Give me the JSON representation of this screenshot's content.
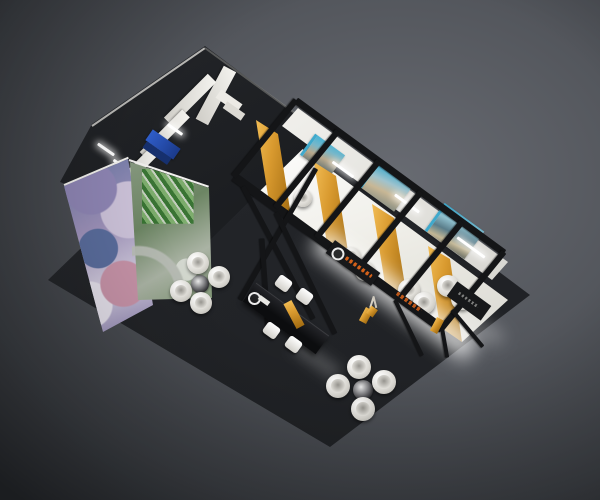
{
  "meta": {
    "title": "3D render of an exhibition stand, aerial isometric view",
    "canvas_width": 600,
    "canvas_height": 500
  },
  "palette": {
    "backdrop_light": "#686b72",
    "backdrop_mid": "#53565c",
    "backdrop_dark": "#3b3e43",
    "platform": "#232528",
    "frame_black": "#141517",
    "wall_dark": "#1d1f22",
    "wall_white": "#edece8",
    "floor_white": "#f6f5f1",
    "gold": "#d99a2f",
    "gold_dark": "#a06a10",
    "poster_teal": "#3fa9cc",
    "chair_white": "#f2f1ec",
    "cabinet_blue": "#2b57c0",
    "accent_orange": "#d2601a"
  },
  "scene": {
    "background": {
      "label": "studio gradient backdrop, brightest upper right"
    },
    "platform": {
      "label": "raised dark charcoal floor platform, diamond orientation"
    },
    "meeting_rooms": {
      "label": "enclosed back rooms with tall charcoal walls",
      "white_partitions": 4,
      "features": [
        "blue cabinet",
        "white counter blocks",
        "wall-mounted screen",
        "ceiling light bars"
      ],
      "graphic_walls": [
        {
          "label": "purple collage graphic wall (front-left face)"
        },
        {
          "label": "aerial green campus photo graphic wall (front-right face)"
        }
      ]
    },
    "booth_row": {
      "label": "row of four open meeting booths with white floors",
      "booth_count": 4,
      "gold_divider_walls": 4,
      "teal_posters": 3,
      "spotlight_strips": 3,
      "white_ball_chairs": 7
    },
    "frame": {
      "label": "black steel truss frame with X cross-braces and legs",
      "fascia_logo": {
        "label": "white circular ring logo on black fascia"
      },
      "fascia_text": {
        "label": "small orange brand lettering (illegible at this scale)"
      }
    },
    "lounge": {
      "label": "open lounge area on dark platform",
      "table_sets": [
        {
          "label": "round chrome table with 4 white ball chairs (left)"
        },
        {
          "label": "round chrome table with 4 white ball chairs (bottom)"
        }
      ]
    },
    "reception": {
      "label": "long black reception counter",
      "features": [
        "gold angled sash",
        "white ring logo on end face",
        "4 white bar stools",
        "decorative twig in gold pot"
      ]
    }
  }
}
